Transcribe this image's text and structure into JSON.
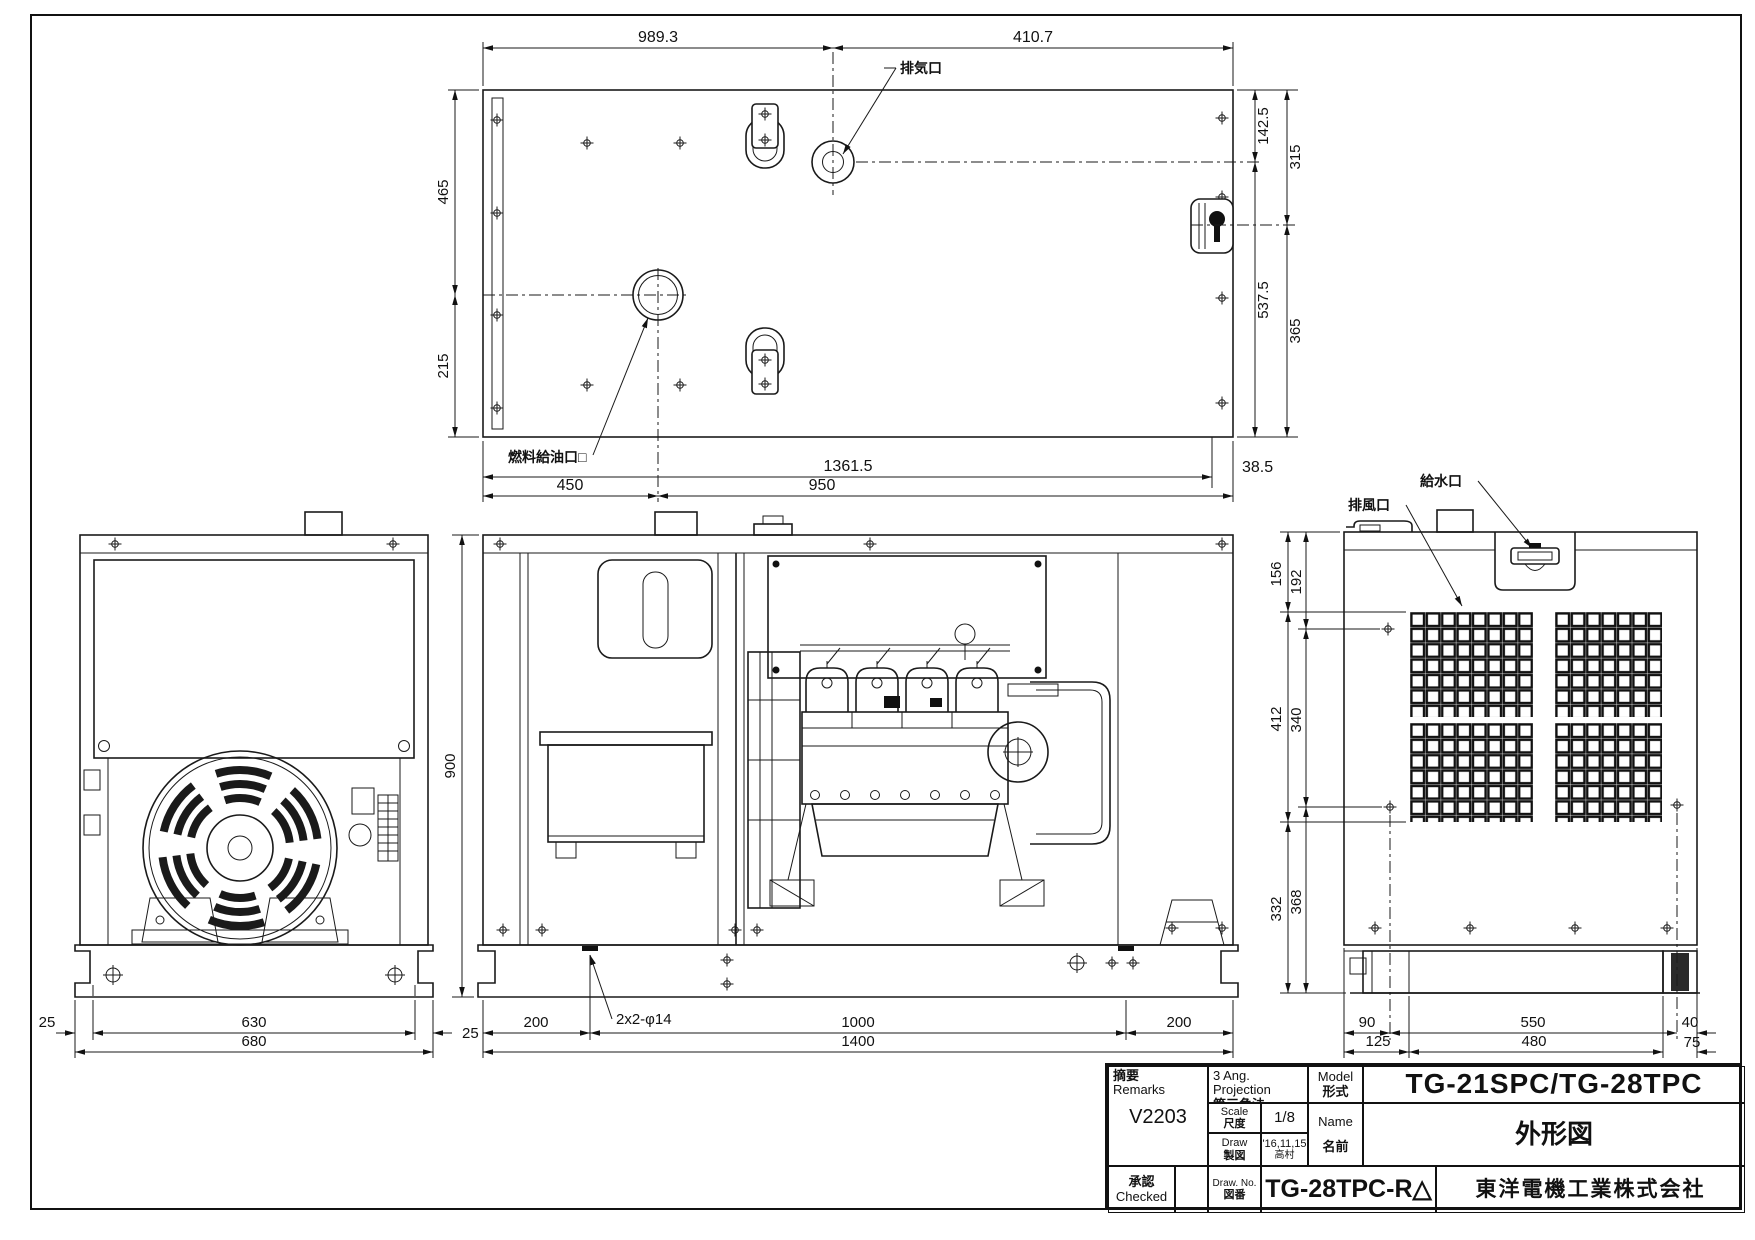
{
  "views": {
    "top": {
      "labels": {
        "exhaust_port": "排気口",
        "fuel_filler": "燃料給油口□"
      },
      "dims": {
        "w_left": "989.3",
        "w_right": "410.7",
        "h_upper": "465",
        "h_lower": "215",
        "r_inner_top": "142.5",
        "r_outer_top": "315",
        "r_inner_bot": "537.5",
        "r_outer_bot": "365",
        "b_left": "450",
        "b_mid": "1361.5",
        "b_right": "950",
        "b_offset": "38.5"
      }
    },
    "left": {
      "dims": {
        "foot_l": "25",
        "bolt_span": "630",
        "foot_r": "25",
        "base_w": "680"
      }
    },
    "front": {
      "labels": {
        "base_holes": "2x2-φ14"
      },
      "dims": {
        "height": "900",
        "b_left": "200",
        "b_mid": "1000",
        "b_right": "200",
        "b_total": "1400"
      }
    },
    "right": {
      "labels": {
        "air_outlet": "排風口",
        "water_inlet": "給水口"
      },
      "dims": {
        "o_top": "156",
        "i_top": "192",
        "o_mid": "412",
        "i_mid": "340",
        "o_bot": "332",
        "i_bot": "368",
        "b_90": "90",
        "b_125": "125",
        "b_550": "550",
        "b_480": "480",
        "b_40": "40",
        "b_75": "75"
      }
    }
  },
  "title_block": {
    "remarks_jp": "摘要",
    "remarks_en": "Remarks",
    "remarks_value": "V2203",
    "projection_en": "3 Ang. Projection",
    "projection_jp": "第三角法",
    "scale_en": "Scale",
    "scale_jp": "尺度",
    "scale_value": "1/8",
    "draw_en": "Draw",
    "draw_jp": "製図",
    "draw_date": "'16,11,15",
    "draw_by": "高村",
    "model_en": "Model",
    "model_jp": "形式",
    "model_value": "TG-21SPC/TG-28TPC",
    "name_en": "Name",
    "name_jp": "名前",
    "name_value": "外形図",
    "approval_jp": "承認",
    "approval_en": "Checked",
    "drawno_en": "Draw. No.",
    "drawno_jp": "図番",
    "drawno_value": "TG-28TPC-R",
    "revision_mark": "△",
    "company": "東洋電機工業株式会社"
  }
}
